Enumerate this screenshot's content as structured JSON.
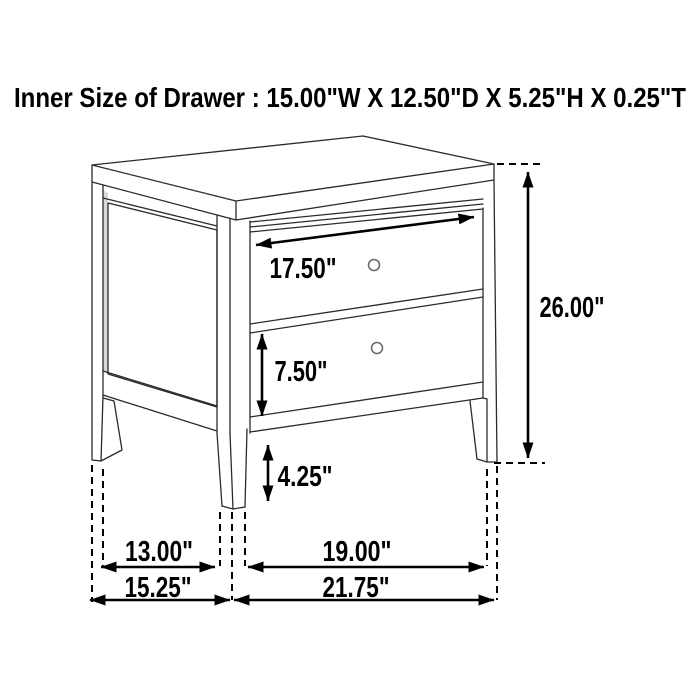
{
  "title": {
    "text": "Inner Size of Drawer : 15.00\"W X 12.50\"D X 5.25\"H X 0.25\"T"
  },
  "drawing": {
    "subject": "two-drawer nightstand line drawing, front-left isometric view",
    "line_color": "#2b2b2b",
    "dimension_color": "#000000",
    "shade_color": "#d9d9d9",
    "background": "#ffffff",
    "knob_count": 2
  },
  "dimensions": {
    "drawer_face_width": "17.50\"",
    "lower_drawer_height": "7.50\"",
    "leg_height": "4.25\"",
    "overall_height": "26.00\"",
    "side_leg_span": "13.00\"",
    "side_overall_depth": "15.25\"",
    "front_leg_span": "19.00\"",
    "front_overall_width": "21.75\""
  }
}
